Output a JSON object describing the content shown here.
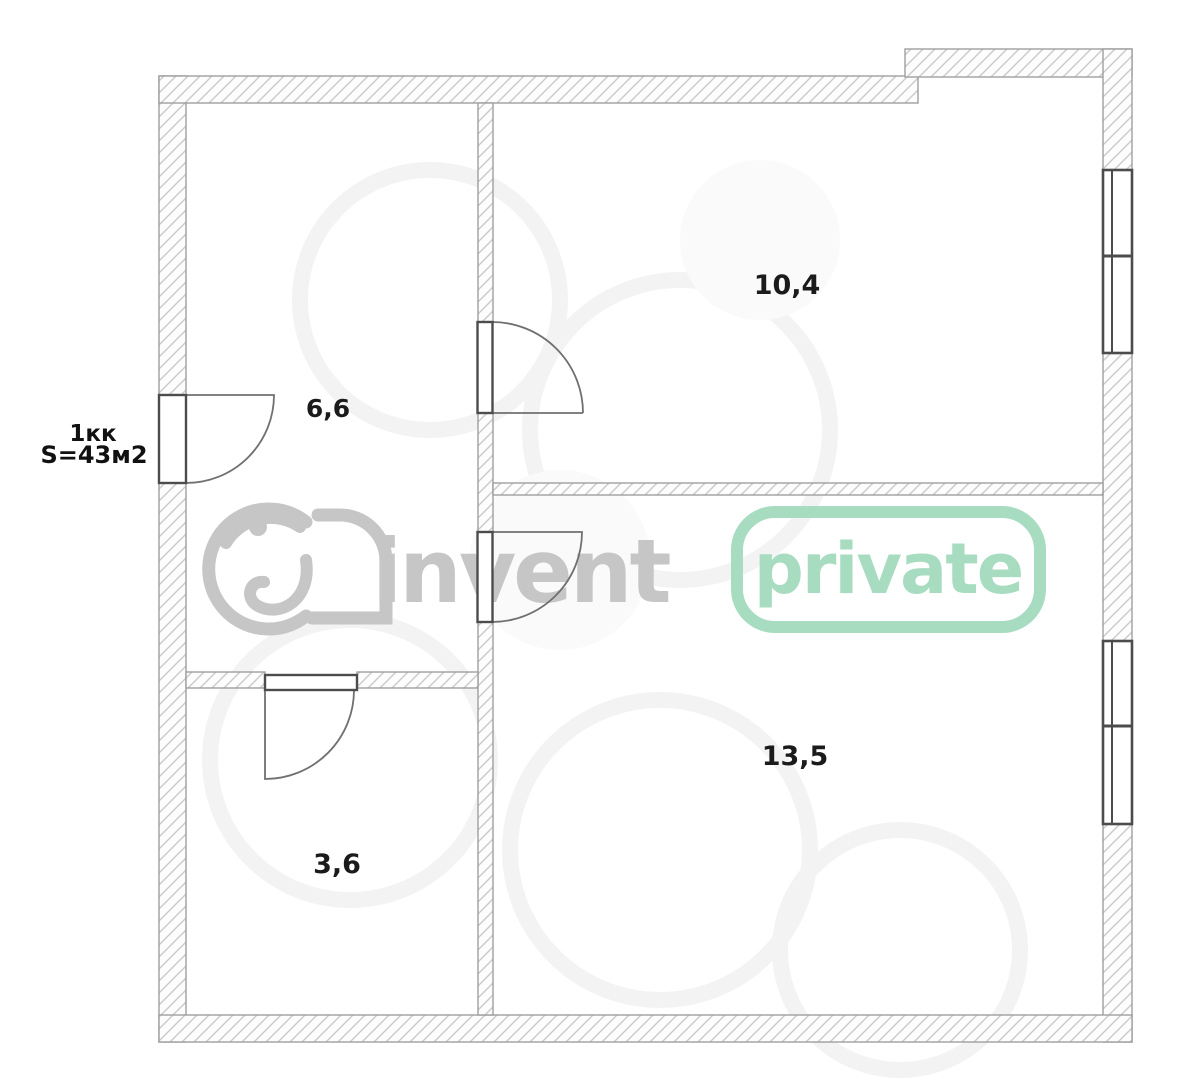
{
  "plan": {
    "apartment_type": "1кк",
    "total_area": "S=43м2",
    "rooms": [
      {
        "name": "room-top-right",
        "area": "10,4"
      },
      {
        "name": "room-top-left",
        "area": "6,6"
      },
      {
        "name": "room-bottom-right",
        "area": "13,5"
      },
      {
        "name": "room-bottom-left",
        "area": "3,6"
      }
    ]
  },
  "watermark": {
    "brand": "invent",
    "badge": "private",
    "brand_color": "#c6c6c6",
    "badge_color": "#a7dcc1"
  },
  "colors": {
    "background": "#ffffff",
    "wall_hatch": "#cccccc",
    "wall_outline": "#9f9f9f",
    "door_window_stroke": "#4c4c4c",
    "door_arc_stroke": "#707070",
    "label_text": "#1b1b1b"
  }
}
